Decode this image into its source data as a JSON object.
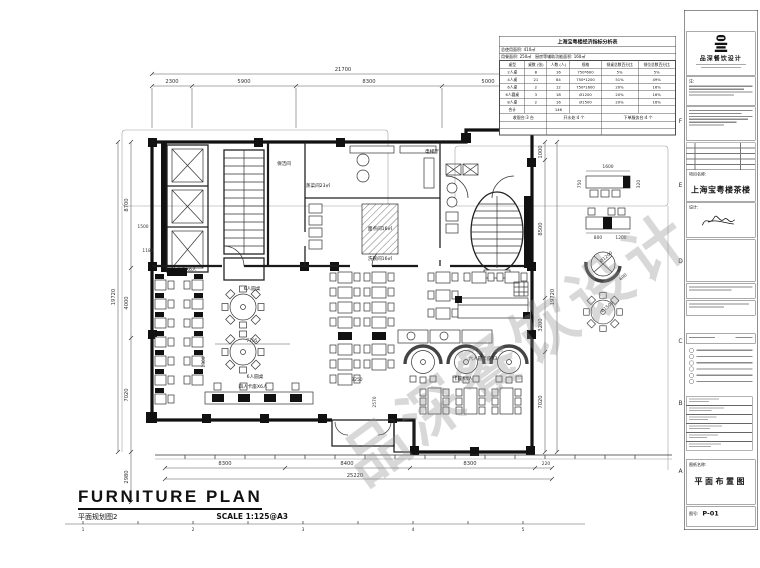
{
  "watermark": "品深餐饮设计",
  "econ_table": {
    "title": "上海宝粤楼经济指标分析表",
    "area_row1": "总使用面积: 410㎡",
    "area_row2_left": "用餐面积: 250㎡",
    "area_row2_right": "厨房等辅助功能面积: 160㎡",
    "headers": [
      "桌型",
      "桌数 (张)",
      "人数 (人)",
      "规格",
      "餐桌总数百分比",
      "餐位总数百分比"
    ],
    "rows": [
      [
        "2人桌",
        "8",
        "16",
        "750*600",
        "5%",
        "5%"
      ],
      [
        "4人桌",
        "21",
        "84",
        "750*1200",
        "51%",
        "49%"
      ],
      [
        "6人桌",
        "2",
        "12",
        "750*1600",
        "20%",
        "16%"
      ],
      [
        "6人圆桌",
        "3",
        "18",
        "Ø1200",
        "20%",
        "16%"
      ],
      [
        "8人桌",
        "2",
        "16",
        "Ø1500",
        "20%",
        "16%"
      ],
      [
        "合计",
        "",
        "146",
        "",
        "",
        ""
      ]
    ],
    "footer": [
      "收银台:3 台",
      "开水处:4 个",
      "下单服务台:4 个"
    ]
  },
  "titleblock": {
    "company": "品深餐饮设计",
    "note_label": "注:",
    "project_label": "项目名称:",
    "project_name": "上海宝粤楼茶楼",
    "design_label": "设计:",
    "drawing_title_label": "图纸名称:",
    "drawing_title": "平面布置图",
    "number_label": "图号:",
    "drawing_number": "P-01",
    "edge_marks": [
      "F",
      "E",
      "D",
      "C",
      "B",
      "A"
    ]
  },
  "footer_title": {
    "main": "FURNITURE PLAN",
    "sub": "平面规划图2",
    "scale": "SCALE  1:125@A3"
  },
  "plan": {
    "dims": {
      "top_total": "21700",
      "top": [
        "2300",
        "5900",
        "8300",
        "5000"
      ],
      "left": [
        "8700",
        "4000",
        "7020"
      ],
      "left_total": "19720",
      "left_extra": "2980",
      "right": [
        "1000",
        "8500",
        "3200",
        "7020"
      ],
      "right_total": "19720",
      "bottom": [
        "8300",
        "8400",
        "8300",
        "220"
      ],
      "bottom_total": "25220",
      "inner": [
        "1500",
        "1180",
        "1300",
        "7195",
        "3250",
        "2570"
      ]
    },
    "labels": {
      "cleaning_room": "保洁间",
      "steam_kitchen": "蒸菜间23㎡",
      "pastry_room": "面点间16㎡",
      "dishwash_room": "洗碗间16㎡",
      "elevator_hall": "电梯厅",
      "round_table_6": "6人圆桌",
      "booth_4x6": "四人卡座X6人",
      "round_booth_3": "六人圆卡座X3",
      "booth_4x4": "卡座X4人"
    },
    "furniture_details": {
      "d1600": "1600",
      "d320": "320",
      "d750": "750",
      "d800": "800",
      "d1200": "1200",
      "dia1200": "Ø1200",
      "d600": "600",
      "dia1500": "Ø1500"
    },
    "scale_ruler": [
      "1",
      "2",
      "3",
      "4",
      "5"
    ]
  }
}
